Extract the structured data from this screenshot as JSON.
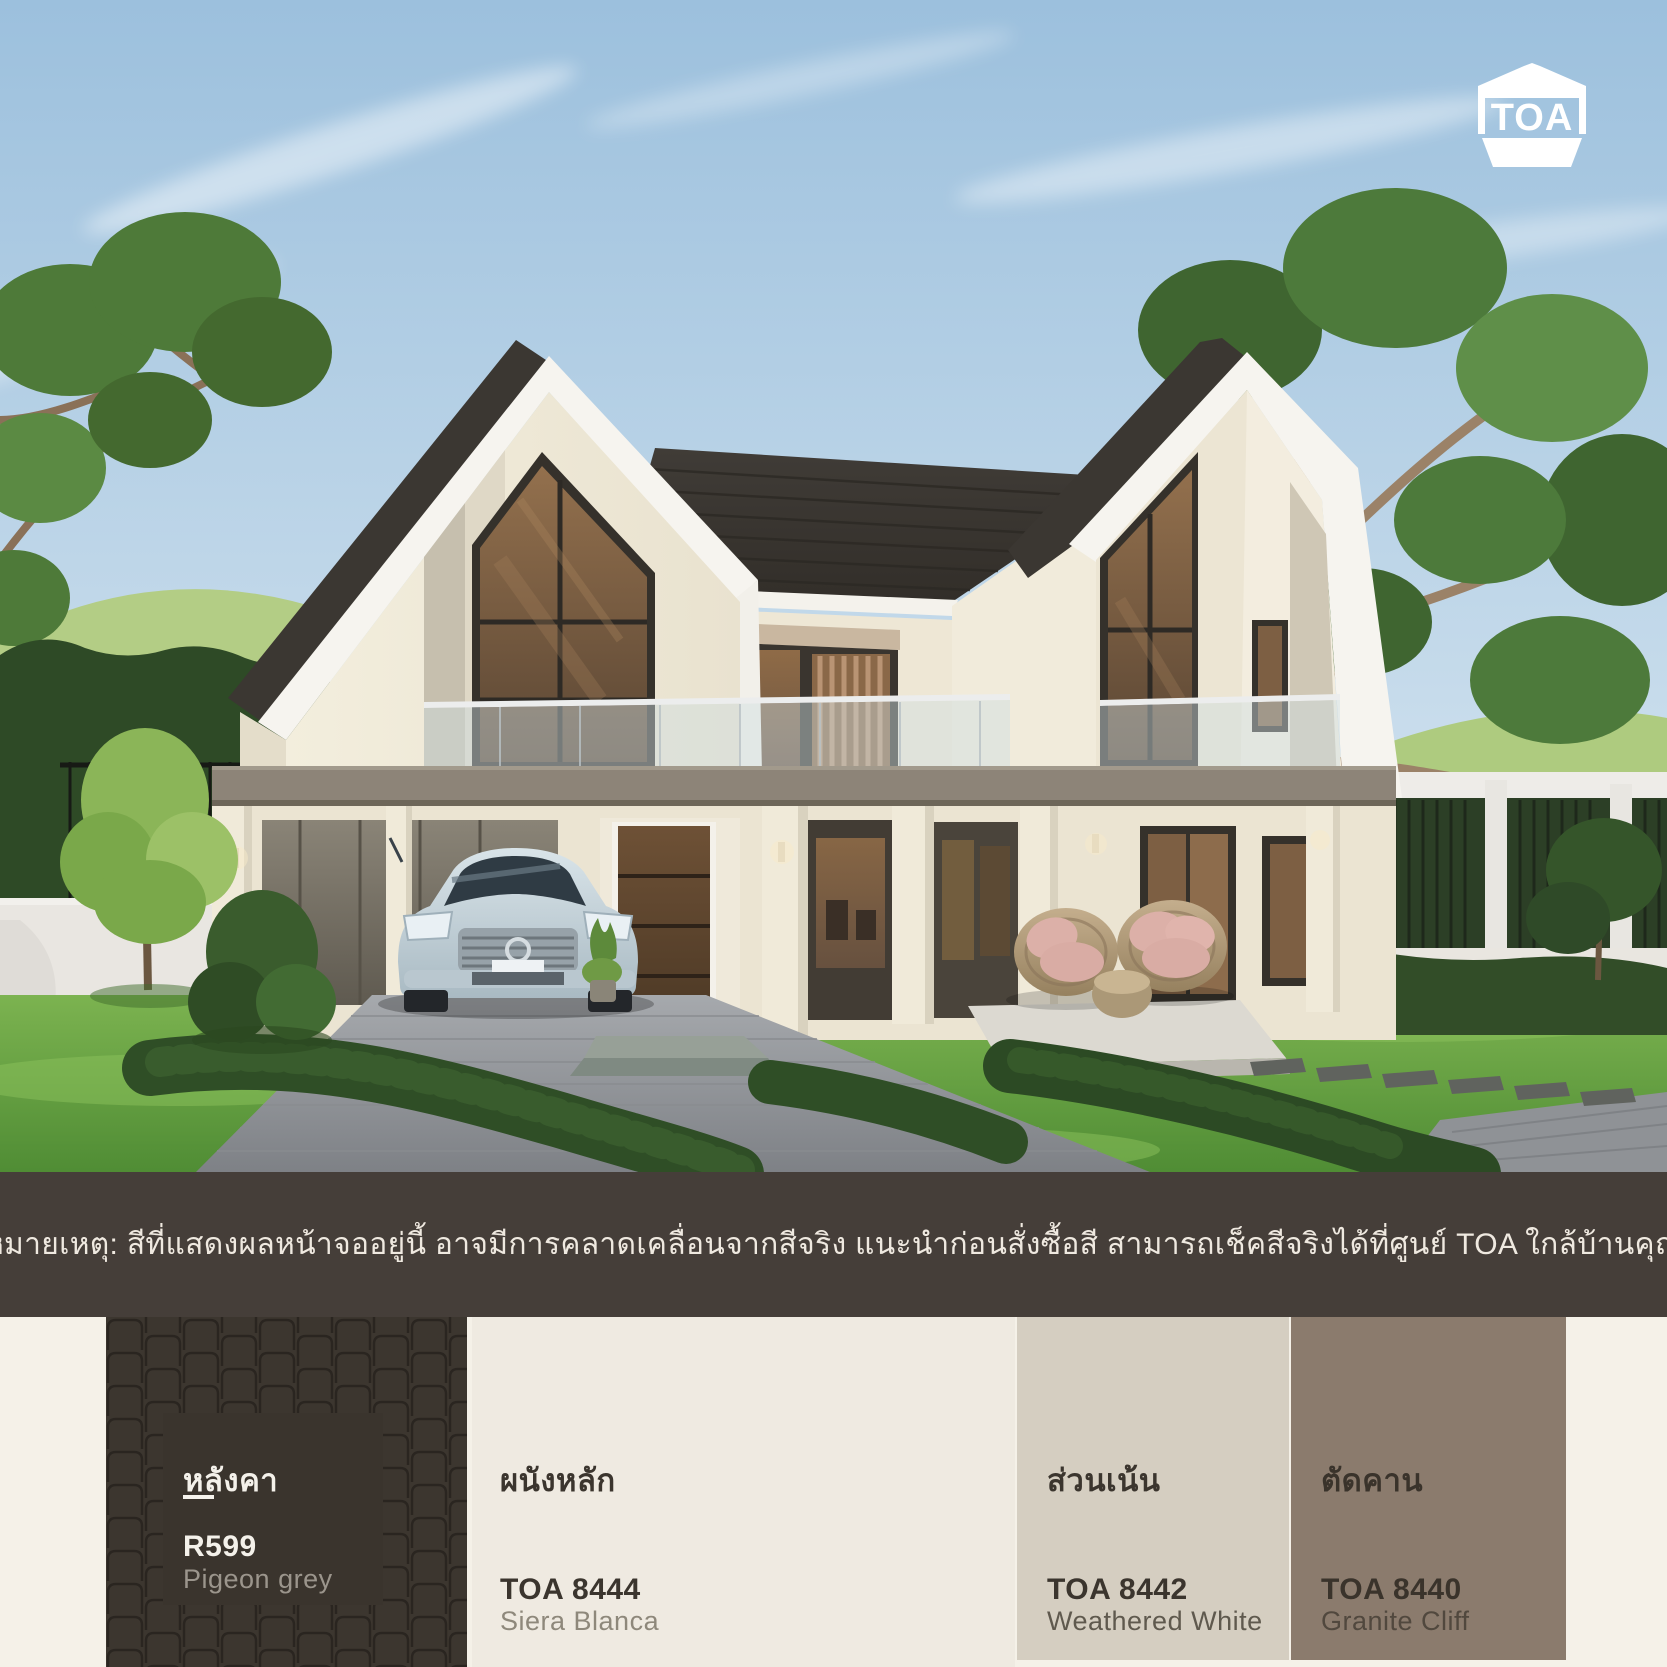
{
  "brand": {
    "name": "TOA",
    "logo_color": "#ffffff"
  },
  "disclaimer": {
    "text": "หมายเหตุ: สีที่แสดงผลหน้าจออยู่นี้ อาจมีการคลาดเคลื่อนจากสีจริง แนะนำก่อนสั่งซื้อสี สามารถเช็คสีจริงได้ที่ศูนย์ TOA ใกล้บ้านคุณ",
    "bar_color": "#453e39",
    "text_color": "#efe9e0"
  },
  "palette": {
    "section_background": "#f5f1e8",
    "swatches": [
      {
        "area_label": "หลังคา",
        "code": "R599",
        "color_name": "Pigeon grey",
        "hex": "#3c362f",
        "pattern": "roof-tile-pattern"
      },
      {
        "area_label": "ผนังหลัก",
        "code": "TOA 8444",
        "color_name": "Siera Blanca",
        "hex": "#efeae1"
      },
      {
        "area_label": "ส่วนเน้น",
        "code": "TOA 8442",
        "color_name": "Weathered White",
        "hex": "#d5cec1"
      },
      {
        "area_label": "ตัดคาน",
        "code": "TOA 8440",
        "color_name": "Granite Cliff",
        "hex": "#8b7b6d"
      }
    ]
  }
}
